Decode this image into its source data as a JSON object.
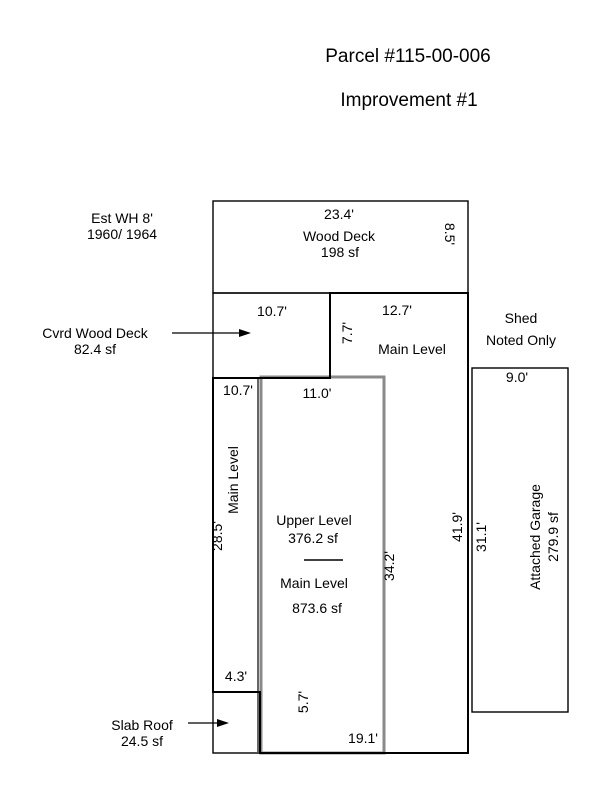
{
  "page": {
    "title_line1": "Parcel #115-00-006",
    "title_line2": "Improvement #1"
  },
  "colors": {
    "background": "#ffffff",
    "line": "#000000",
    "upper_level_line": "#8a8a8a",
    "text": "#000000"
  },
  "annotations": {
    "est_wh": {
      "line1": "Est WH 8'",
      "line2": "1960/ 1964"
    },
    "cvrd_wood_deck": {
      "line1": "Cvrd Wood Deck",
      "line2": "82.4 sf"
    },
    "slab_roof": {
      "line1": "Slab Roof",
      "line2": "24.5 sf"
    },
    "shed": {
      "line1": "Shed",
      "line2": "Noted Only"
    }
  },
  "sketch": {
    "wood_deck": {
      "width": "23.4'",
      "name": "Wood Deck",
      "area": "198 sf",
      "depth": "8.5'"
    },
    "cvrd_deck": {
      "width": "10.7'",
      "depth": "7.7'"
    },
    "main_level_top": {
      "width": "12.7'",
      "name": "Main Level"
    },
    "left_wing": {
      "top": "10.7'",
      "name": "Main Level",
      "side": "28.5'",
      "jog": "4.3'"
    },
    "upper_box": {
      "width": "11.0'",
      "side": "34.2'",
      "name": "Upper Level",
      "area": "376.2 sf"
    },
    "main_center": {
      "name": "Main Level",
      "area": "873.6 sf",
      "side": "41.9'",
      "bottom": "19.1'",
      "slab_side": "5.7'"
    },
    "garage": {
      "width": "9.0'",
      "side": "31.1'",
      "name": "Attached Garage",
      "area": "279.9 sf"
    }
  }
}
